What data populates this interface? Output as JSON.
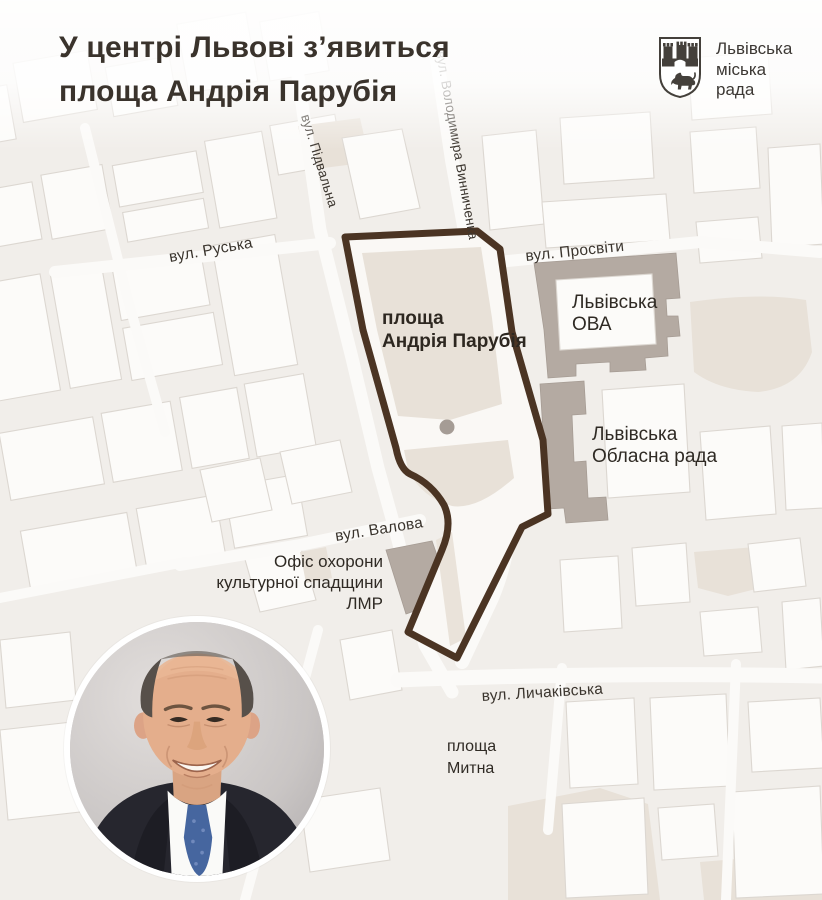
{
  "header": {
    "title_line1": "У центрі Львові з’явиться",
    "title_line2": "площа Андрія Парубія",
    "logo": {
      "line1": "Львівська",
      "line2": "міська",
      "line3": "рада"
    }
  },
  "map": {
    "streets": {
      "ruska": "вул. Руська",
      "pidvalna": "вул. Підвальна",
      "vynnychenka": "вул. Володимира Винниченка",
      "prosvity": "вул. Просвіти",
      "valova": "вул. Валова",
      "lychakivska": "вул. Личаківська"
    },
    "areas": {
      "square_line1": "площа",
      "square_line2": "Андрія Парубія",
      "ova_line1": "Львівська",
      "ova_line2": "ОВА",
      "oblrada_line1": "Львівська",
      "oblrada_line2": "Обласна рада",
      "heritage_line1": "Офіс охорони",
      "heritage_line2": "культурної спадщини",
      "heritage_line3": "ЛМР",
      "mytna_line1": "площа",
      "mytna_line2": "Митна"
    },
    "colors": {
      "square_outline": "#4b3423",
      "government_building": "#b4aaa2",
      "map_background": "#f1eeea",
      "beige_block": "#e8e1d8",
      "marker_dot": "#a59c95"
    },
    "icons": {
      "square_marker": "monument-dot"
    }
  },
  "photo": {
    "icon": "parubiy-portrait-photo"
  }
}
